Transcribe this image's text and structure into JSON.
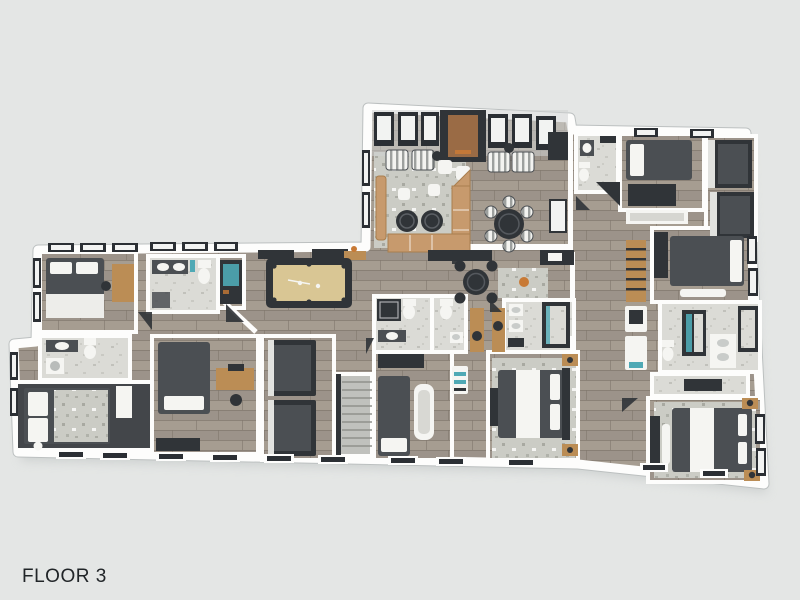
{
  "title": {
    "label": "FLOOR 3"
  },
  "palette": {
    "background": "#e4e6e5",
    "shadow": "#c9cdcc",
    "text": "#212528",
    "wall": "#fdfdfc",
    "wall_edge": "#bcc0c0",
    "floor_wood": "#a69d91",
    "floor_wood2": "#9c938a",
    "floor_wood_line": "#80776c",
    "floor_light": "#dbdbd6",
    "floor_light_speck": "#b7b7b0",
    "floor_dark": "#43464a",
    "stair": "#c0c1bd",
    "stair_line": "#8f918c",
    "rug_base": "#cbccc5",
    "rug_speck": "#9fa098",
    "furn_dark": "#4b4f53",
    "furn_darker": "#303438",
    "furn_white": "#f5f5f2",
    "tan": "#c79a6d",
    "tan_edge": "#a97f4e",
    "wood": "#bb8d55",
    "pool_felt": "#d9c694",
    "teal": "#4fa9b5",
    "orange": "#c87a36",
    "window_frame": "#2b2f34",
    "window_glass": "#f2f3f2",
    "fireplace_brown": "#9a6b45"
  }
}
